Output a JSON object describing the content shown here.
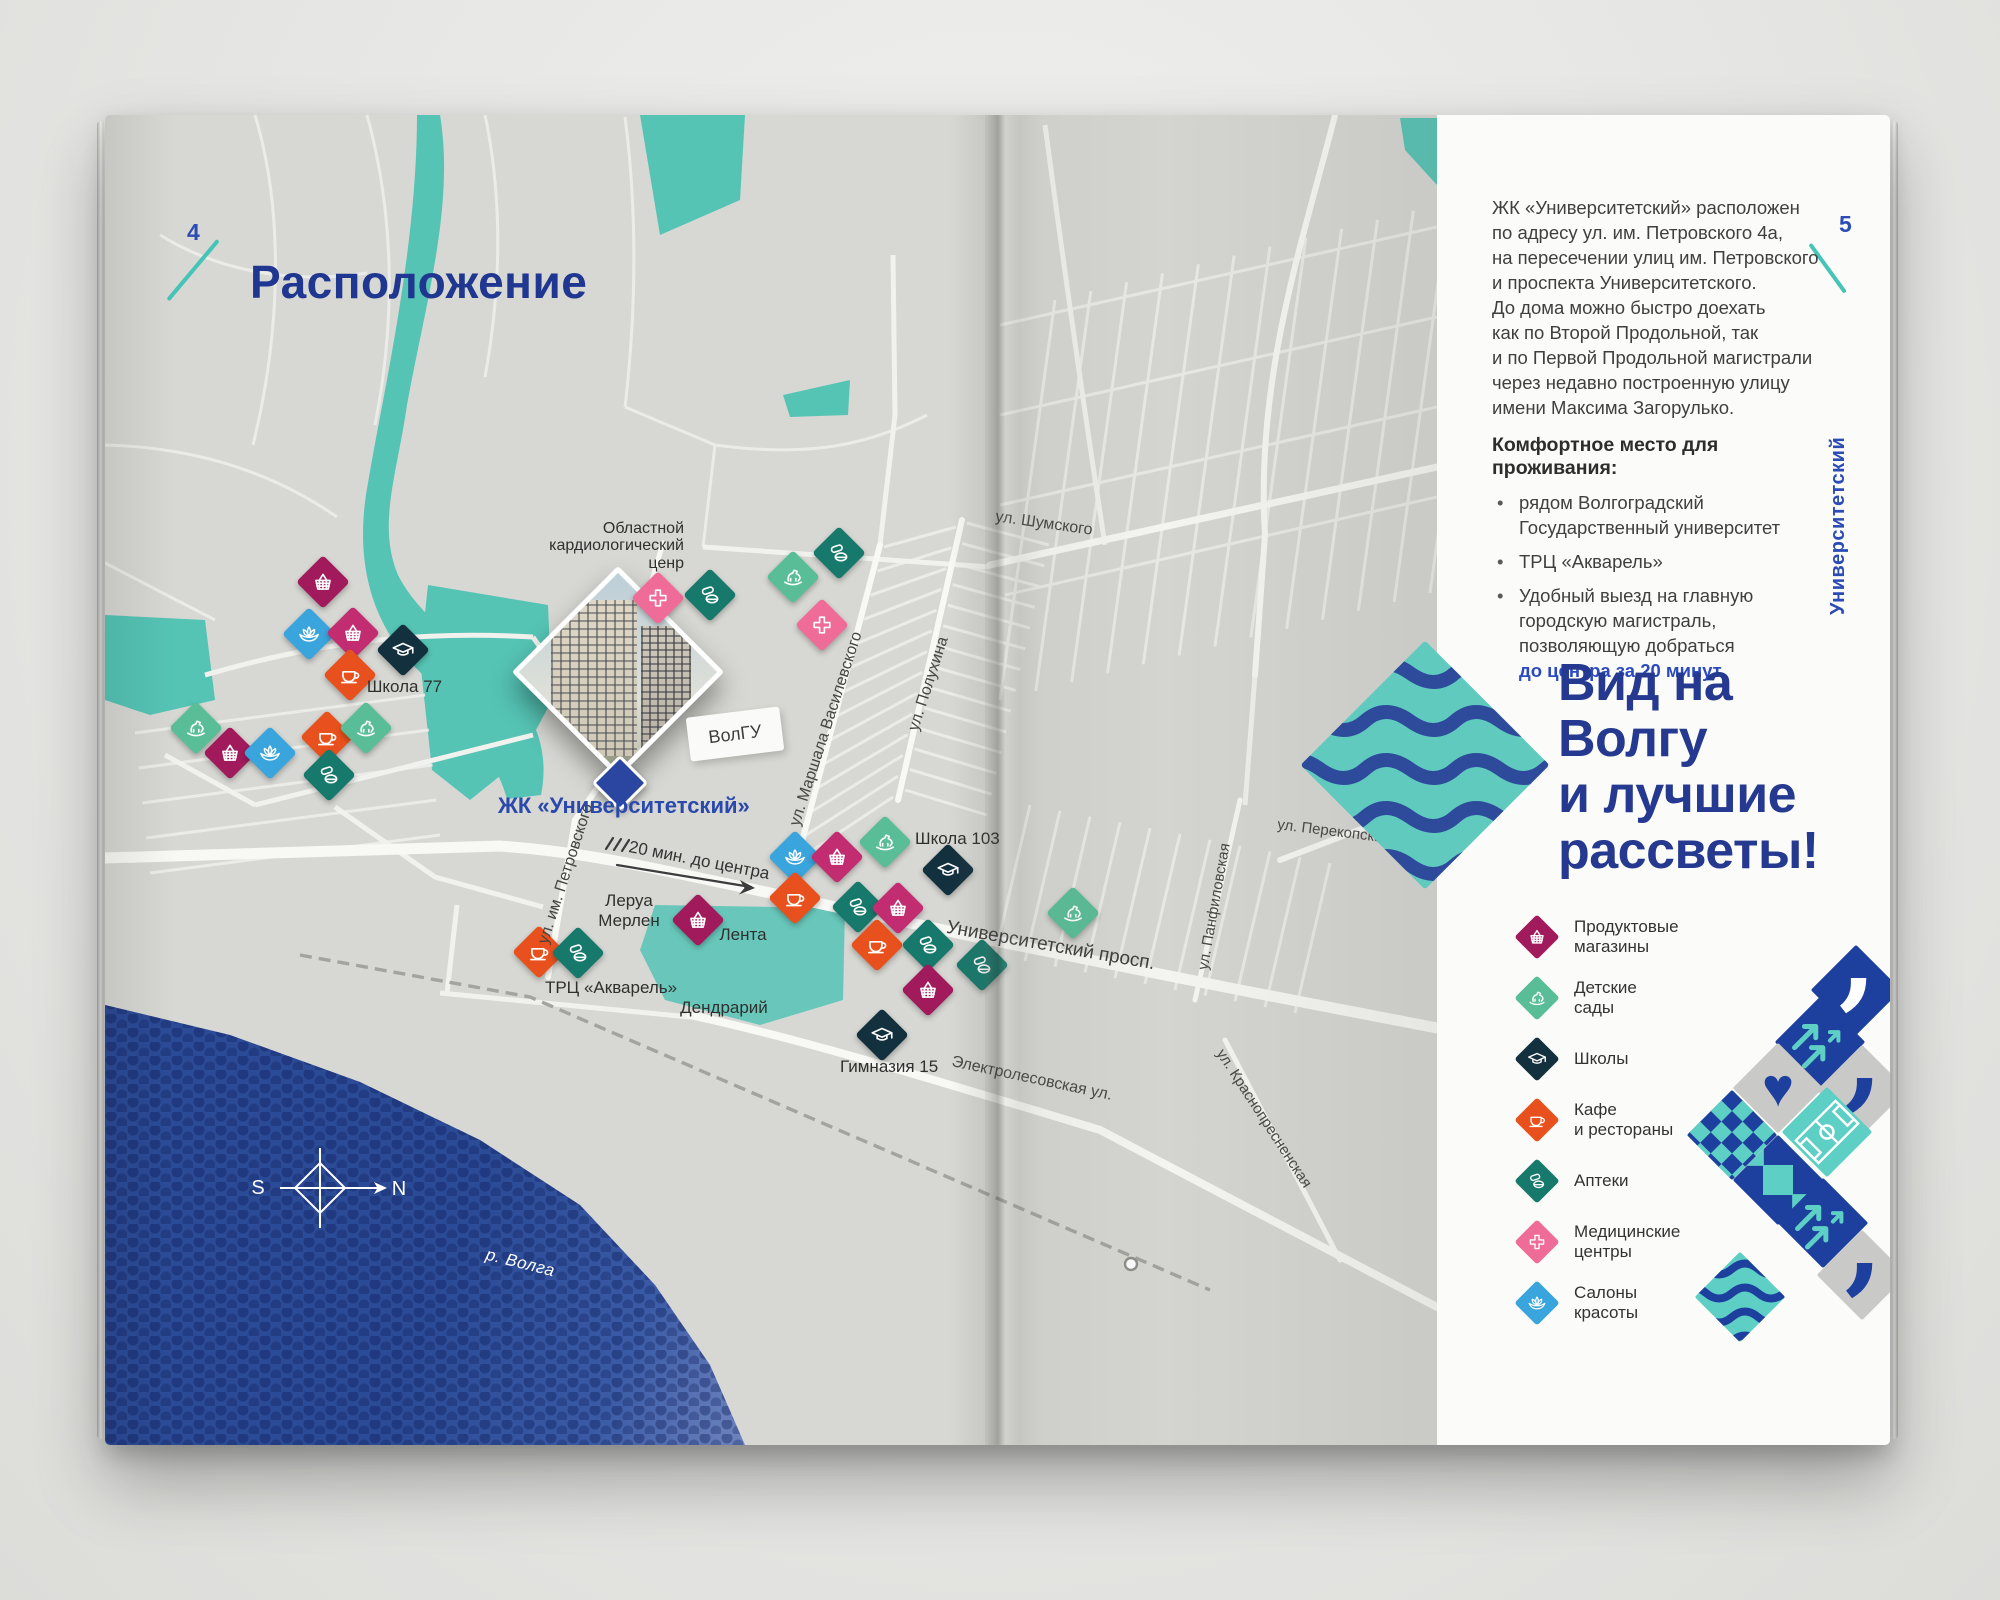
{
  "colors": {
    "accent_blue": "#24398f",
    "brand_blue": "#2b4bb5",
    "teal": "#57c5b6",
    "river_blue": "#2c4b97",
    "highlight_blue": "#2b49c0",
    "marker_grocery": "#a11a5c",
    "marker_grocery_alt": "#c22d72",
    "marker_kindergarten": "#59be97",
    "marker_school": "#13303e",
    "marker_cafe": "#e8511d",
    "marker_pharmacy": "#16796b",
    "marker_medical": "#ef6c99",
    "marker_beauty": "#3aa4dc"
  },
  "left_page": {
    "page_number": "4",
    "title": "Расположение",
    "compass": {
      "south": "S",
      "north": "N"
    },
    "river_label": "р. Волга",
    "route_note": "20 мин. до центра",
    "complex_label": "ЖК «Университетский»",
    "pois": {
      "cardio_lines": [
        "Областной",
        "кардиологический",
        "ценр"
      ],
      "school77": "Школа 77",
      "volgu": "ВолГУ",
      "leroy_lines": [
        "Леруа",
        "Мерлен"
      ],
      "lenta": "Лента",
      "akvarel": "ТРЦ «Акварель»",
      "dendrarium": "Дендрарий",
      "school103": "Школа 103",
      "gymnasium15": "Гимназия 15"
    },
    "streets": [
      {
        "text": "ул. Шумского"
      },
      {
        "text": "ул. Полухина"
      },
      {
        "text": "ул. Маршала Василевского"
      },
      {
        "text": "ул. им. Петровского"
      },
      {
        "text": "Университетский просп."
      },
      {
        "text": "Электролесовская ул."
      },
      {
        "text": "ул. Перекопская"
      },
      {
        "text": "ул. Панфиловская"
      },
      {
        "text": "ул. Краснопресненская"
      }
    ],
    "map": {
      "markers": [
        {
          "t": "basket",
          "x": 218,
          "y": 467
        },
        {
          "t": "lotus",
          "x": 204,
          "y": 519
        },
        {
          "t": "basket2",
          "x": 248,
          "y": 518
        },
        {
          "t": "school",
          "x": 298,
          "y": 535
        },
        {
          "t": "cafe",
          "x": 245,
          "y": 560
        },
        {
          "t": "horse",
          "x": 91,
          "y": 613
        },
        {
          "t": "basket",
          "x": 125,
          "y": 638
        },
        {
          "t": "lotus",
          "x": 165,
          "y": 638
        },
        {
          "t": "cafe",
          "x": 222,
          "y": 622
        },
        {
          "t": "pills",
          "x": 224,
          "y": 660
        },
        {
          "t": "horse",
          "x": 261,
          "y": 613
        },
        {
          "t": "cross",
          "x": 553,
          "y": 483
        },
        {
          "t": "pills",
          "x": 605,
          "y": 480
        },
        {
          "t": "horse",
          "x": 688,
          "y": 462
        },
        {
          "t": "pills",
          "x": 734,
          "y": 438
        },
        {
          "t": "cross",
          "x": 717,
          "y": 510
        },
        {
          "t": "cafe",
          "x": 434,
          "y": 837
        },
        {
          "t": "pills",
          "x": 473,
          "y": 838
        },
        {
          "t": "basket",
          "x": 593,
          "y": 805
        },
        {
          "t": "lotus",
          "x": 690,
          "y": 742
        },
        {
          "t": "basket2",
          "x": 732,
          "y": 742
        },
        {
          "t": "horse",
          "x": 780,
          "y": 727
        },
        {
          "t": "cafe",
          "x": 690,
          "y": 783
        },
        {
          "t": "pills",
          "x": 753,
          "y": 792
        },
        {
          "t": "basket2",
          "x": 793,
          "y": 793
        },
        {
          "t": "school",
          "x": 843,
          "y": 755
        },
        {
          "t": "cafe",
          "x": 772,
          "y": 830
        },
        {
          "t": "pills",
          "x": 823,
          "y": 830
        },
        {
          "t": "basket",
          "x": 823,
          "y": 875
        },
        {
          "t": "school",
          "x": 777,
          "y": 920
        },
        {
          "t": "horse",
          "x": 968,
          "y": 798
        },
        {
          "t": "pills",
          "x": 877,
          "y": 850
        }
      ]
    }
  },
  "right_page": {
    "page_number": "5",
    "side_label": "Университетский",
    "intro_lines": [
      "ЖК «Университетский» расположен",
      "по адресу ул. им. Петровского 4а,",
      "на пересечении улиц им. Петровского",
      "и проспекта Университетского.",
      "До дома можно быстро доехать",
      "как по Второй Продольной, так",
      "и по Первой Продольной магистрали",
      "через недавно построенную улицу",
      "имени Максима Загорулько."
    ],
    "comfort_heading": "Комфортное место для проживания:",
    "bullets": [
      {
        "lines": [
          "рядом Волгоградский",
          "Государственный университет"
        ]
      },
      {
        "lines": [
          "ТРЦ «Акварель»"
        ]
      },
      {
        "lines": [
          "Удобный выезд на главную",
          "городскую магистраль,",
          "позволяющую добраться"
        ],
        "highlight": "до центра за 20 минут"
      }
    ],
    "headline_lines": [
      "Вид на",
      "Волгу",
      "и лучшие",
      "рассветы!"
    ],
    "legend": [
      {
        "icon": "basket",
        "lines": [
          "Продуктовые",
          "магазины"
        ]
      },
      {
        "icon": "horse",
        "lines": [
          "Детские",
          "сады"
        ]
      },
      {
        "icon": "school",
        "lines": [
          "Школы"
        ]
      },
      {
        "icon": "cafe",
        "lines": [
          "Кафе",
          "и рестораны"
        ]
      },
      {
        "icon": "pills",
        "lines": [
          "Аптеки"
        ]
      },
      {
        "icon": "cross",
        "lines": [
          "Медицинские",
          "центры"
        ]
      },
      {
        "icon": "lotus",
        "lines": [
          "Салоны",
          "красоты"
        ]
      }
    ]
  }
}
